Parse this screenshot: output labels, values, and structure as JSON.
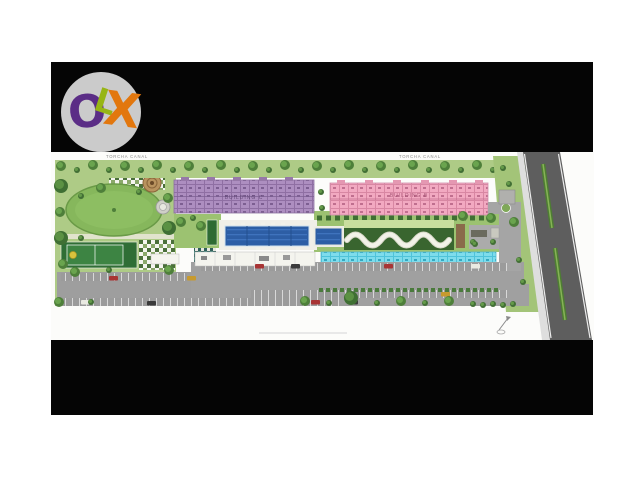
{
  "watermark": {
    "brand": "OLX",
    "letters": [
      "O",
      "L",
      "X"
    ],
    "letter_colors": [
      "#5b2d86",
      "#97b515",
      "#e2770e"
    ],
    "circle_color": "#cbcbcb"
  },
  "letterbox_color": "#050505",
  "site_plan": {
    "canal_label_left": "TORCHA CANAL",
    "canal_label_right": "TORCHA CANAL",
    "buildings": [
      {
        "label": "BUILDING A",
        "color": "#7edcec"
      },
      {
        "label": "BUILDING B",
        "color": "#f2a9c1"
      },
      {
        "label": "BUILDING C",
        "color": "#ad8ec0"
      }
    ],
    "colors": {
      "grass": "#aecb86",
      "lawn_oval": "#86b75c",
      "pool_blue": "#2d5ea5",
      "parking_gray": "#9e9e9e",
      "main_road_gray": "#5e5e5e",
      "road_median_green": "#4e7d33",
      "sports_court_green": "#2f6e35"
    }
  }
}
